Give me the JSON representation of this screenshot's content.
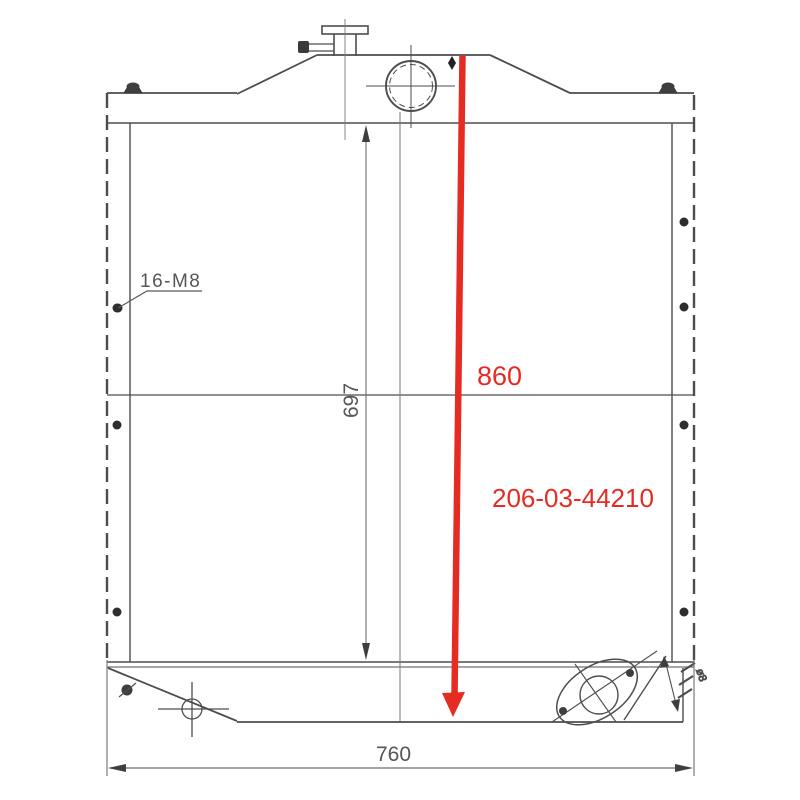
{
  "annotations": {
    "overall_height": "860",
    "part_number": "206-03-44210"
  },
  "dimensions": {
    "core_height": "697",
    "overall_width": "760",
    "bolt_spec": "16-M8",
    "outlet_note": "ø8"
  },
  "colors": {
    "line": "#4d4d4d",
    "dim": "#6e6e6e",
    "annotation_red": "#e62b22",
    "background": "#ffffff"
  }
}
